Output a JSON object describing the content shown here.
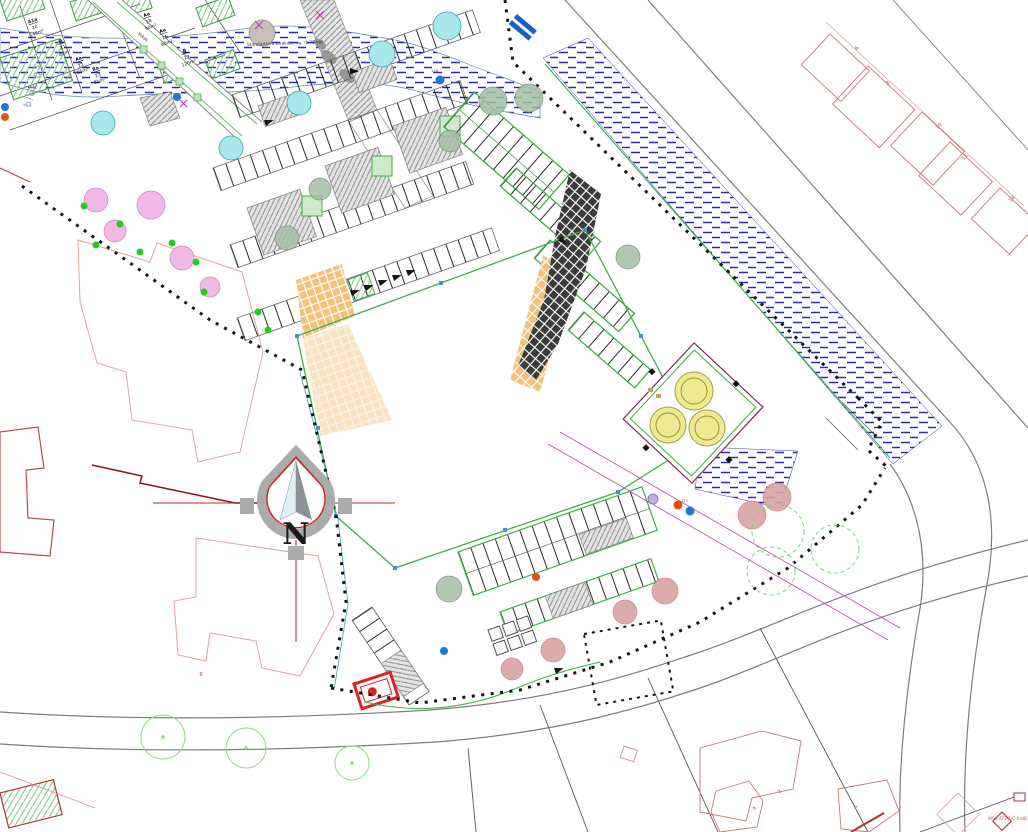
{
  "colors": {
    "site_green": "#3fae49",
    "water_hatch_blue": "#2b2bb0",
    "tree_cyan": "#a9e8ea",
    "tree_pink": "#f2b8e6",
    "tree_rose": "#dba3a3",
    "tree_yellow": "#efe88a",
    "tree_sage": "#a3bfa3",
    "existing_building_red": "#c0504d",
    "parcel_pink": "#e8a7a7",
    "dot_blue": "#1e78d7",
    "dot_orange": "#e8500f",
    "utility_magenta": "#b050b0",
    "crosswalk_orange": "#f2c27b",
    "compass_green": "#5a9a5a",
    "compass_red": "#cc2222",
    "green_dot": "#22cc22"
  },
  "compass": {
    "letter": "N"
  },
  "annotations": {
    "blok_label": "blok 03",
    "road_note": "Standartlara bırakılan uy. -1.75 kot",
    "street_name": "sokak",
    "plan_ref": "W08-AT3-1/C-tretB",
    "dot_label_top": "126",
    "dot_label_right": "127"
  },
  "blok03_plots": [
    {
      "code": "A1a",
      "no": "20",
      "area": "146m²"
    },
    {
      "code": "A",
      "no": "21",
      "area": "85m²"
    },
    {
      "code": "Aa",
      "no": "22",
      "area": "85m²"
    },
    {
      "code": "Ba",
      "no": "23",
      "area": "85m²"
    },
    {
      "code": "Aa",
      "no": "18",
      "area": "90m²"
    },
    {
      "code": "Aa",
      "no": "16",
      "area": "90m²"
    },
    {
      "code": "B",
      "no": "13",
      "area": "120m²"
    }
  ],
  "house_numbers": {
    "upper_right": [
      "6",
      "8",
      "10",
      "12",
      "14"
    ],
    "bottom_right": [
      "2",
      "4",
      "1"
    ],
    "left": [
      "8"
    ]
  }
}
